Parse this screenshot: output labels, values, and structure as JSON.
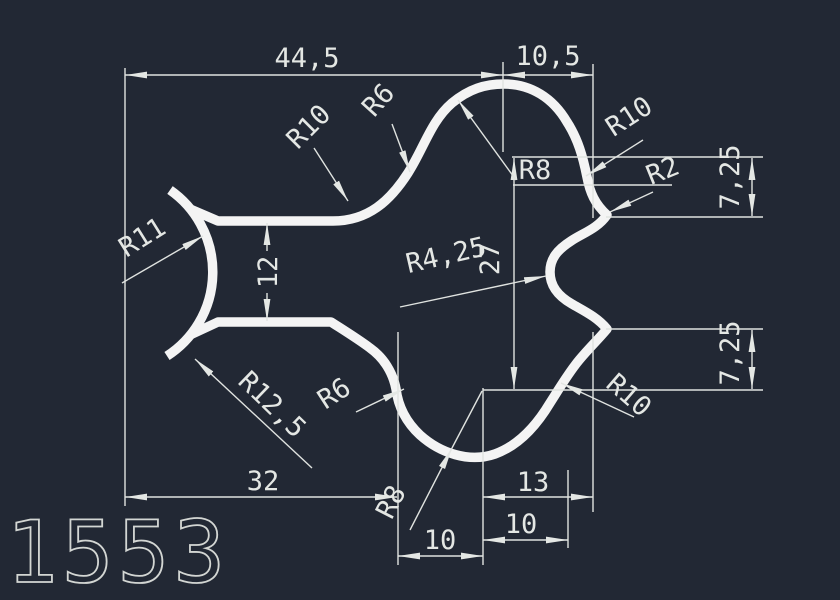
{
  "drawing": {
    "part_number": "1553",
    "colors": {
      "background": "#222834",
      "profile_line": "#f4f4f4",
      "dimension_line": "#e0e3e0",
      "text": "#e4e7e4"
    },
    "linear_dimensions": {
      "top_width": "44,5",
      "top_right_width": "10,5",
      "slot_height": "12",
      "right_height": "27",
      "upper_right_offset": "7,25",
      "lower_right_offset": "7,25",
      "bottom_width": "32",
      "bottom_lobe_width": "10",
      "bottom_right_width": "13",
      "bottom_right_width2": "10"
    },
    "radius_labels": {
      "top_left_fillet": "R10",
      "top_curve": "R6",
      "dome": "R8",
      "upper_right_fillet": "R10",
      "upper_right_corner": "R2",
      "claw_inner": "R11",
      "claw_outer": "R12,5",
      "notch": "R4,25",
      "bottom_curve": "R6",
      "bottom_lobe": "R8",
      "lower_right_corner": "R2",
      "lower_right_fillet": "R10"
    }
  }
}
